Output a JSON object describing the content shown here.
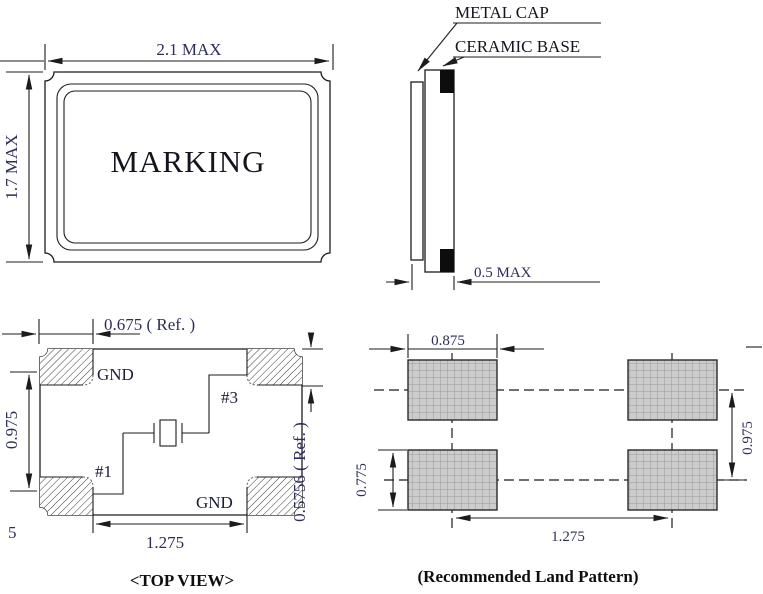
{
  "front_view": {
    "width_dim": "2.1 MAX",
    "height_dim": "1.7 MAX",
    "marking": "MARKING"
  },
  "side_view": {
    "cap_label": "METAL CAP",
    "base_label": "CERAMIC BASE",
    "thickness_dim": "0.5 MAX"
  },
  "top_view": {
    "caption": "<TOP VIEW>",
    "offset_dim": "0.675 ( Ref. )",
    "vertical_span_dim": "0.975",
    "horizontal_span_dim": "1.275",
    "right_ref_dim": "0.5756 ( Ref. )",
    "pad_top_left": "GND",
    "pad_top_right": "#3",
    "pad_bottom_left": "#1",
    "pad_bottom_right": "GND",
    "stray_char": "5"
  },
  "land_pattern": {
    "caption": "(Recommended Land Pattern)",
    "pad_width_dim": "0.875",
    "pad_height_dim": "0.775",
    "row_pitch_dim": "0.975",
    "column_pitch_dim": "1.275"
  },
  "colors": {
    "line": "#1c1c1c",
    "dim_text": "#2d2d5a",
    "pad_fill": "#cccccc",
    "pad_grid_line": "#9a9a9a"
  }
}
